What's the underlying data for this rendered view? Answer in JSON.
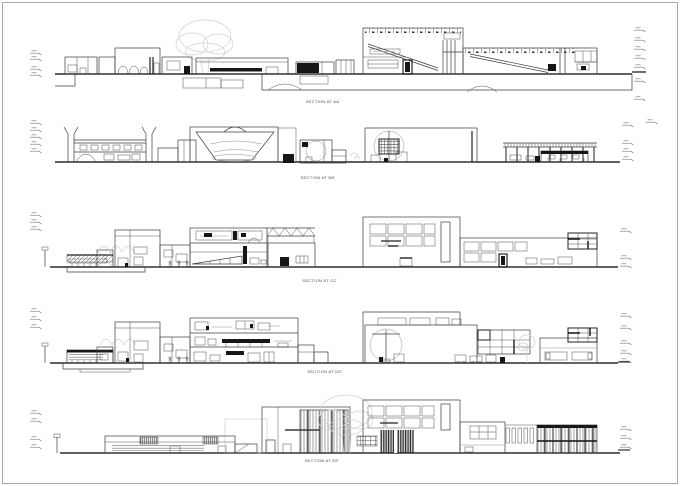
{
  "sheet": {
    "type": "architectural-section-sheet",
    "background_color": "#ffffff",
    "border_color": "#a9a9a9",
    "line_color": "#3d3d3d",
    "dark_fill_color": "#161616",
    "sketch_color": "#cfcfcf"
  },
  "sections": [
    {
      "name": "aa",
      "label": "SECTION AT AA'"
    },
    {
      "name": "bb",
      "label": "SECTION AT BB'"
    },
    {
      "name": "cc",
      "label": "SECTION AT CC'"
    },
    {
      "name": "dd",
      "label": "SECTION AT DD'"
    },
    {
      "name": "ee",
      "label": "SECTION AT EE'"
    }
  ]
}
